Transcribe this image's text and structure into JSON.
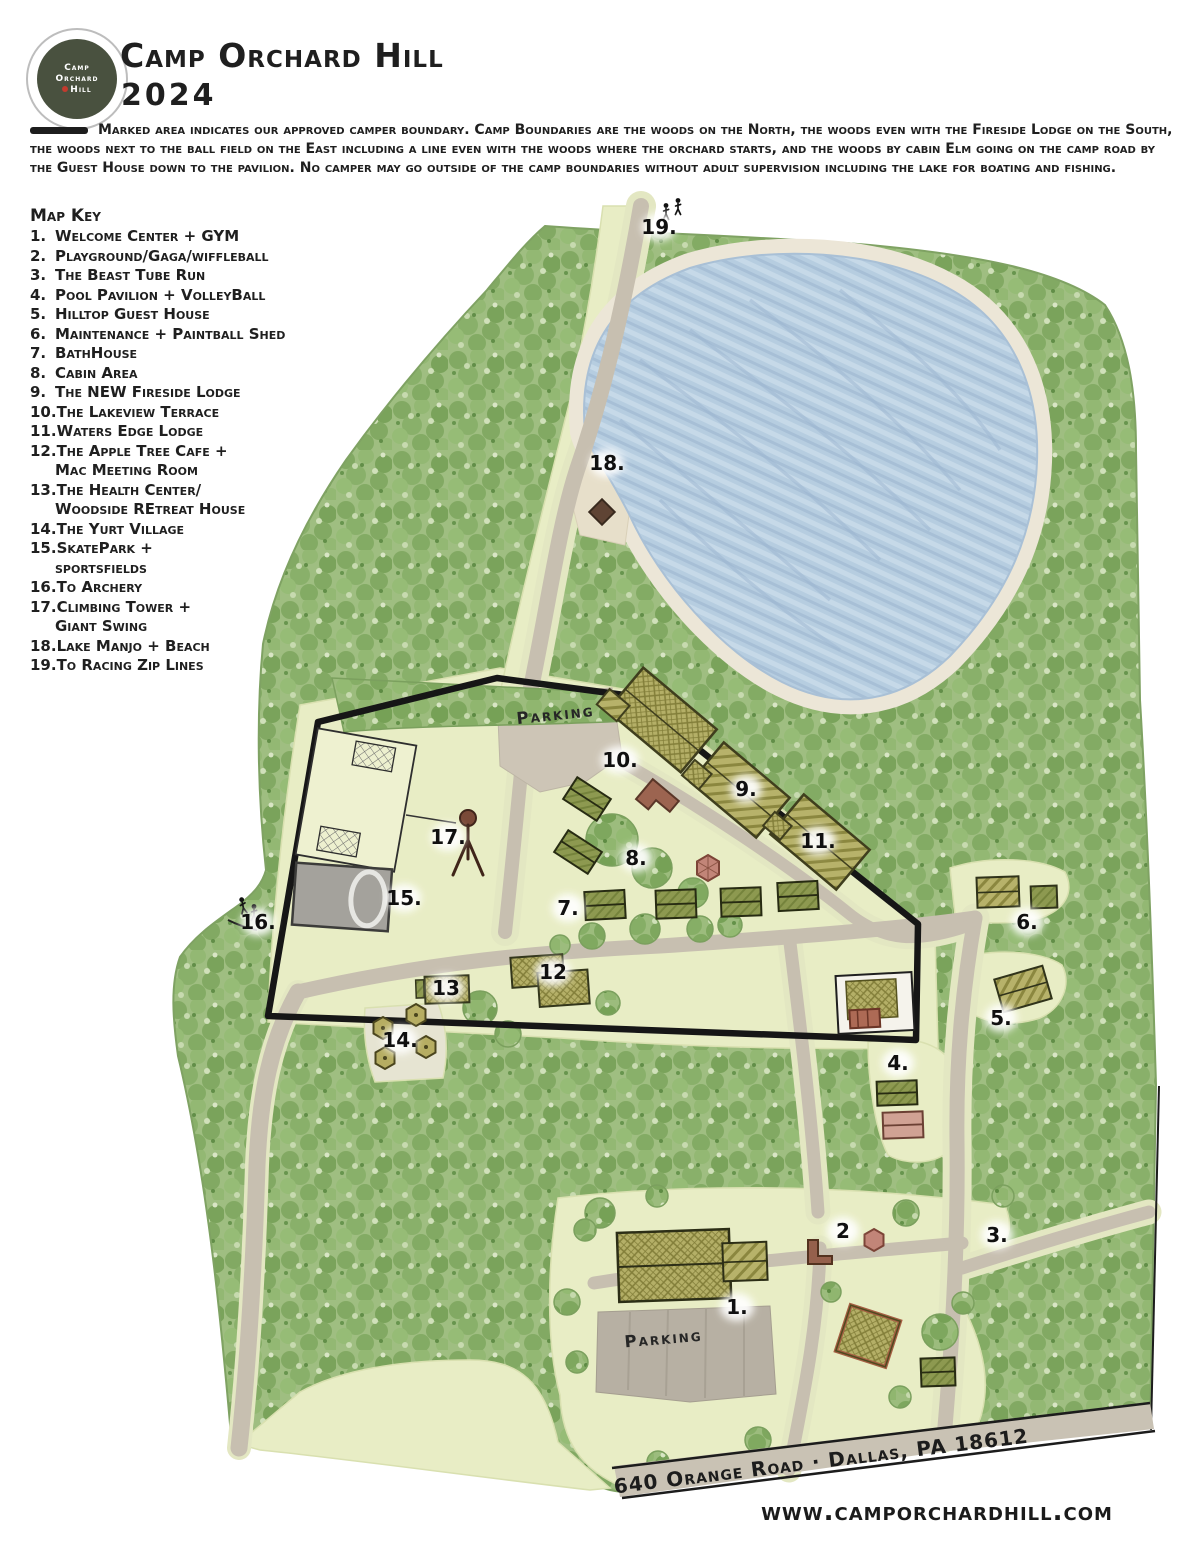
{
  "header": {
    "title": "Camp Orchard Hill",
    "year": "2024",
    "logo": {
      "line1": "Camp",
      "line2": "Orchard",
      "line3": "Hill"
    }
  },
  "boundary_note": "Marked area indicates our approved camper boundary.  Camp Boundaries are the woods on the North, the woods even with the Fireside Lodge on the South, the woods next to the ball field on the East including a line even with the woods where the orchard starts, and the woods by cabin Elm going on the camp road by the Guest House down to the pavilion.  No camper may go outside of the camp boundaries without adult supervision including the lake for boating and fishing.",
  "map_key": {
    "title": "Map Key",
    "items": [
      {
        "num": "1.",
        "label": "Welcome Center + GYM"
      },
      {
        "num": "2.",
        "label": "Playground/Gaga/wiffleball"
      },
      {
        "num": "3.",
        "label": "The Beast Tube Run"
      },
      {
        "num": "4.",
        "label": "Pool Pavilion + VolleyBall"
      },
      {
        "num": "5.",
        "label": "Hilltop Guest House"
      },
      {
        "num": "6.",
        "label": "Maintenance + Paintball Shed"
      },
      {
        "num": "7.",
        "label": "BathHouse"
      },
      {
        "num": "8.",
        "label": "Cabin Area"
      },
      {
        "num": "9.",
        "label": "The NEW Fireside Lodge"
      },
      {
        "num": "10.",
        "label": "The Lakeview Terrace"
      },
      {
        "num": "11.",
        "label": "Waters Edge Lodge"
      },
      {
        "num": "12.",
        "label": "The Apple Tree Cafe +",
        "label2": "Mac Meeting Room"
      },
      {
        "num": "13.",
        "label": "The Health Center/",
        "label2": "Woodside REtreat House"
      },
      {
        "num": "14.",
        "label": "The Yurt Village"
      },
      {
        "num": "15.",
        "label": "SkatePark +",
        "label2": "sportsfields"
      },
      {
        "num": "16.",
        "label": "To Archery"
      },
      {
        "num": "17.",
        "label": "Climbing Tower +",
        "label2": "Giant Swing"
      },
      {
        "num": "18.",
        "label": "Lake Manjo + Beach"
      },
      {
        "num": "19.",
        "label": "To Racing Zip Lines"
      }
    ]
  },
  "map": {
    "markers": [
      {
        "label": "1."
      },
      {
        "label": "2"
      },
      {
        "label": "3."
      },
      {
        "label": "4."
      },
      {
        "label": "5."
      },
      {
        "label": "6."
      },
      {
        "label": "7."
      },
      {
        "label": "8."
      },
      {
        "label": "9."
      },
      {
        "label": "10."
      },
      {
        "label": "11."
      },
      {
        "label": "12"
      },
      {
        "label": "13"
      },
      {
        "label": "14."
      },
      {
        "label": "15."
      },
      {
        "label": "16."
      },
      {
        "label": "17."
      },
      {
        "label": "18."
      },
      {
        "label": "19."
      }
    ],
    "parking_north": "Parking",
    "parking_south": "Parking",
    "address": "640 Orange Road · Dallas, PA 18612",
    "website": "www.camporchardhill.com"
  },
  "colors": {
    "forest": "#9cbc7d",
    "clearing": "#e8edc5",
    "lake": "#b6cde0",
    "road": "#c7bfb0",
    "boundary": "#161616",
    "building_roof": "#b4af67",
    "cabin": "#8d9950",
    "accent_red": "#ad6a55",
    "logo_bg": "#49513f"
  }
}
